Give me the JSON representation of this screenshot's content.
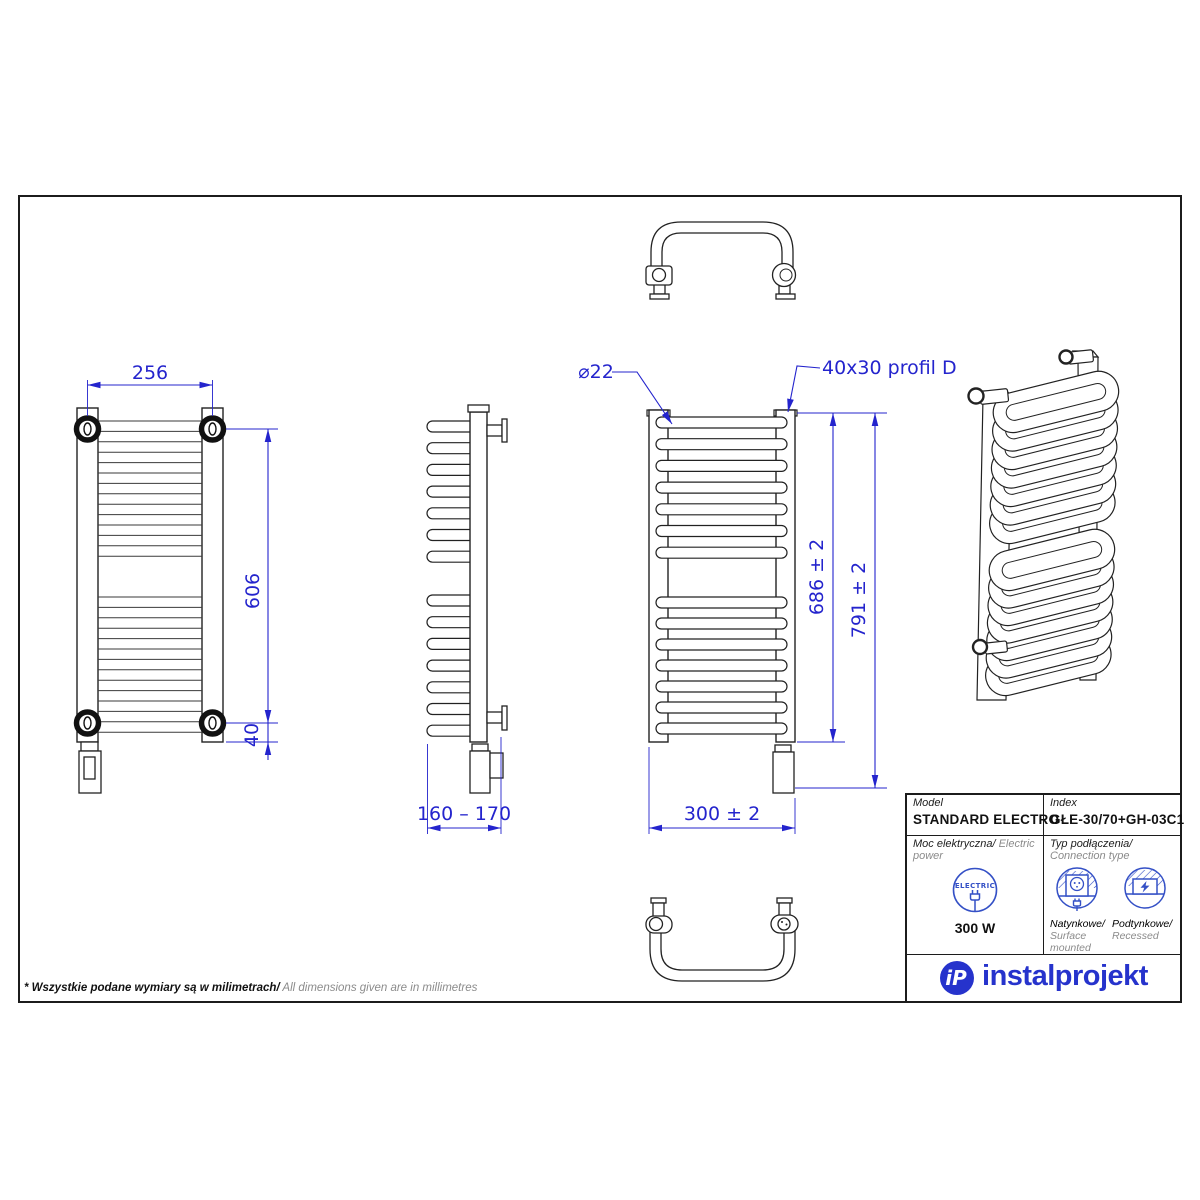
{
  "sheet": {
    "note_pl": "* Wszystkie podane wymiary są w milimetrach/",
    "note_en": " All dimensions given are in millimetres"
  },
  "dimensions": {
    "front_width": "256",
    "front_height": "606",
    "front_bottom_offset": "40",
    "side_depth": "160 – 170",
    "mid_width": "300 ± 2",
    "mid_height_inner": "686 ± 2",
    "mid_height_total": "791 ± 2",
    "tube_diameter": "⌀22",
    "profile_label": "40x30 profil D"
  },
  "title_block": {
    "model_label": "Model",
    "model_value": "STANDARD ELECTRO",
    "index_label": "Index",
    "index_value": "GŁE-30/70+GH-03C1",
    "power_label_pl": "Moc elektryczna/",
    "power_label_en": " Electric power",
    "power_icon_text": "ELECTRIC",
    "power_value": "300 W",
    "connection_label_pl": "Typ podłączenia/",
    "connection_label_en": "Connection type",
    "surface_pl": "Natynkowe/",
    "surface_en": "Surface mounted",
    "recessed_pl": "Podtynkowe/",
    "recessed_en": "Recessed",
    "brand": "instalprojekt",
    "brand_monogram": "iP"
  },
  "colors": {
    "dimension_blue": "#2424cd",
    "icon_blue": "#3450c6",
    "brand_blue": "#2633cc",
    "line_black": "#1c1c1c",
    "muted_gray": "#8b8b8b"
  },
  "views": {
    "front_line_counts": {
      "top": 14,
      "bottom": 14
    },
    "loop_counts": {
      "top": 7,
      "bottom": 7
    }
  }
}
